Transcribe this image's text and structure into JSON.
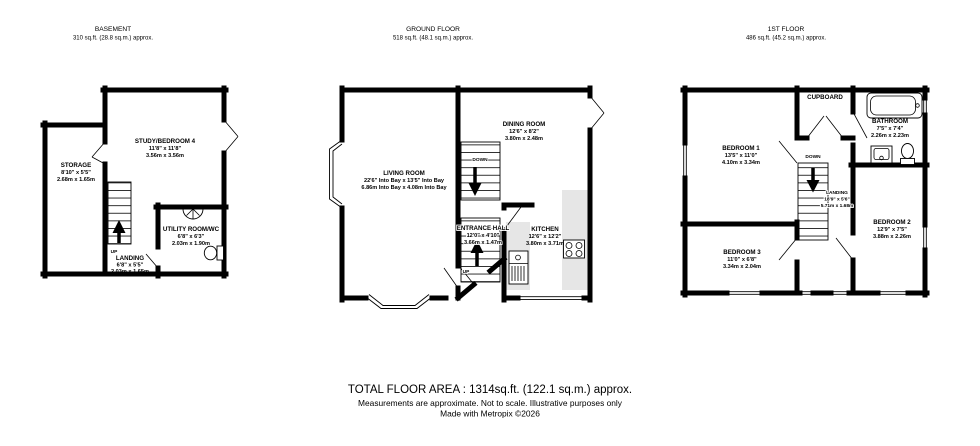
{
  "footer": {
    "total_area": "TOTAL FLOOR AREA : 1314sq.ft. (122.1 sq.m.) approx.",
    "disclaimer": "Measurements are approximate.  Not to scale.  Illustrative purposes only",
    "credit": "Made with Metropix ©2026"
  },
  "floors": {
    "basement": {
      "title": "BASEMENT",
      "area": "310 sq.ft. (28.8 sq.m.) approx.",
      "labels": {
        "up": "UP"
      },
      "rooms": {
        "study": {
          "name": "STUDY/BEDROOM 4",
          "dims_ft": "11'8\" x 11'8\"",
          "dims_m": "3.56m x 3.56m"
        },
        "storage": {
          "name": "STORAGE",
          "dims_ft": "8'10\" x 5'5\"",
          "dims_m": "2.68m x 1.65m"
        },
        "landing": {
          "name": "LANDING",
          "dims_ft": "6'8\" x 5'5\"",
          "dims_m": "2.03m x 1.65m"
        },
        "utility": {
          "name": "UTILITY ROOM/WC",
          "dims_ft": "6'8\" x 6'3\"",
          "dims_m": "2.03m x 1.90m"
        }
      }
    },
    "ground": {
      "title": "GROUND FLOOR",
      "area": "518 sq.ft. (48.1 sq.m.) approx.",
      "labels": {
        "up": "UP",
        "down": "DOWN"
      },
      "rooms": {
        "living": {
          "name": "LIVING ROOM",
          "dims_ft": "22'6\" Into Bay x 13'5\" Into Bay",
          "dims_m": "6.86m Into Bay x 4.08m Into Bay"
        },
        "dining": {
          "name": "DINING ROOM",
          "dims_ft": "12'6\" x 8'2\"",
          "dims_m": "3.80m x 2.48m"
        },
        "kitchen": {
          "name": "KITCHEN",
          "dims_ft": "12'6\" x 12'2\"",
          "dims_m": "3.80m x 3.71m"
        },
        "hall": {
          "name": "ENTRANCE HALL",
          "dims_ft": "12'0\" x 4'10\"",
          "dims_m": "3.66m x 1.47m"
        }
      }
    },
    "first": {
      "title": "1ST FLOOR",
      "area": "486 sq.ft. (45.2 sq.m.) approx.",
      "labels": {
        "down": "DOWN"
      },
      "rooms": {
        "bedroom1": {
          "name": "BEDROOM 1",
          "dims_ft": "13'5\" x 11'0\"",
          "dims_m": "4.10m x 3.34m"
        },
        "bedroom2": {
          "name": "BEDROOM 2",
          "dims_ft": "12'9\" x 7'5\"",
          "dims_m": "3.88m x 2.26m"
        },
        "bedroom3": {
          "name": "BEDROOM 3",
          "dims_ft": "11'0\" x 6'8\"",
          "dims_m": "3.34m x 2.04m"
        },
        "bathroom": {
          "name": "BATHROOM",
          "dims_ft": "7'5\" x 7'4\"",
          "dims_m": "2.26m x 2.23m"
        },
        "landing": {
          "name": "LANDING",
          "dims_ft": "18'9\" x 5'6\"",
          "dims_m": "5.71m x 1.68m"
        },
        "cupboard": {
          "name": "CUPBOARD"
        }
      }
    }
  }
}
